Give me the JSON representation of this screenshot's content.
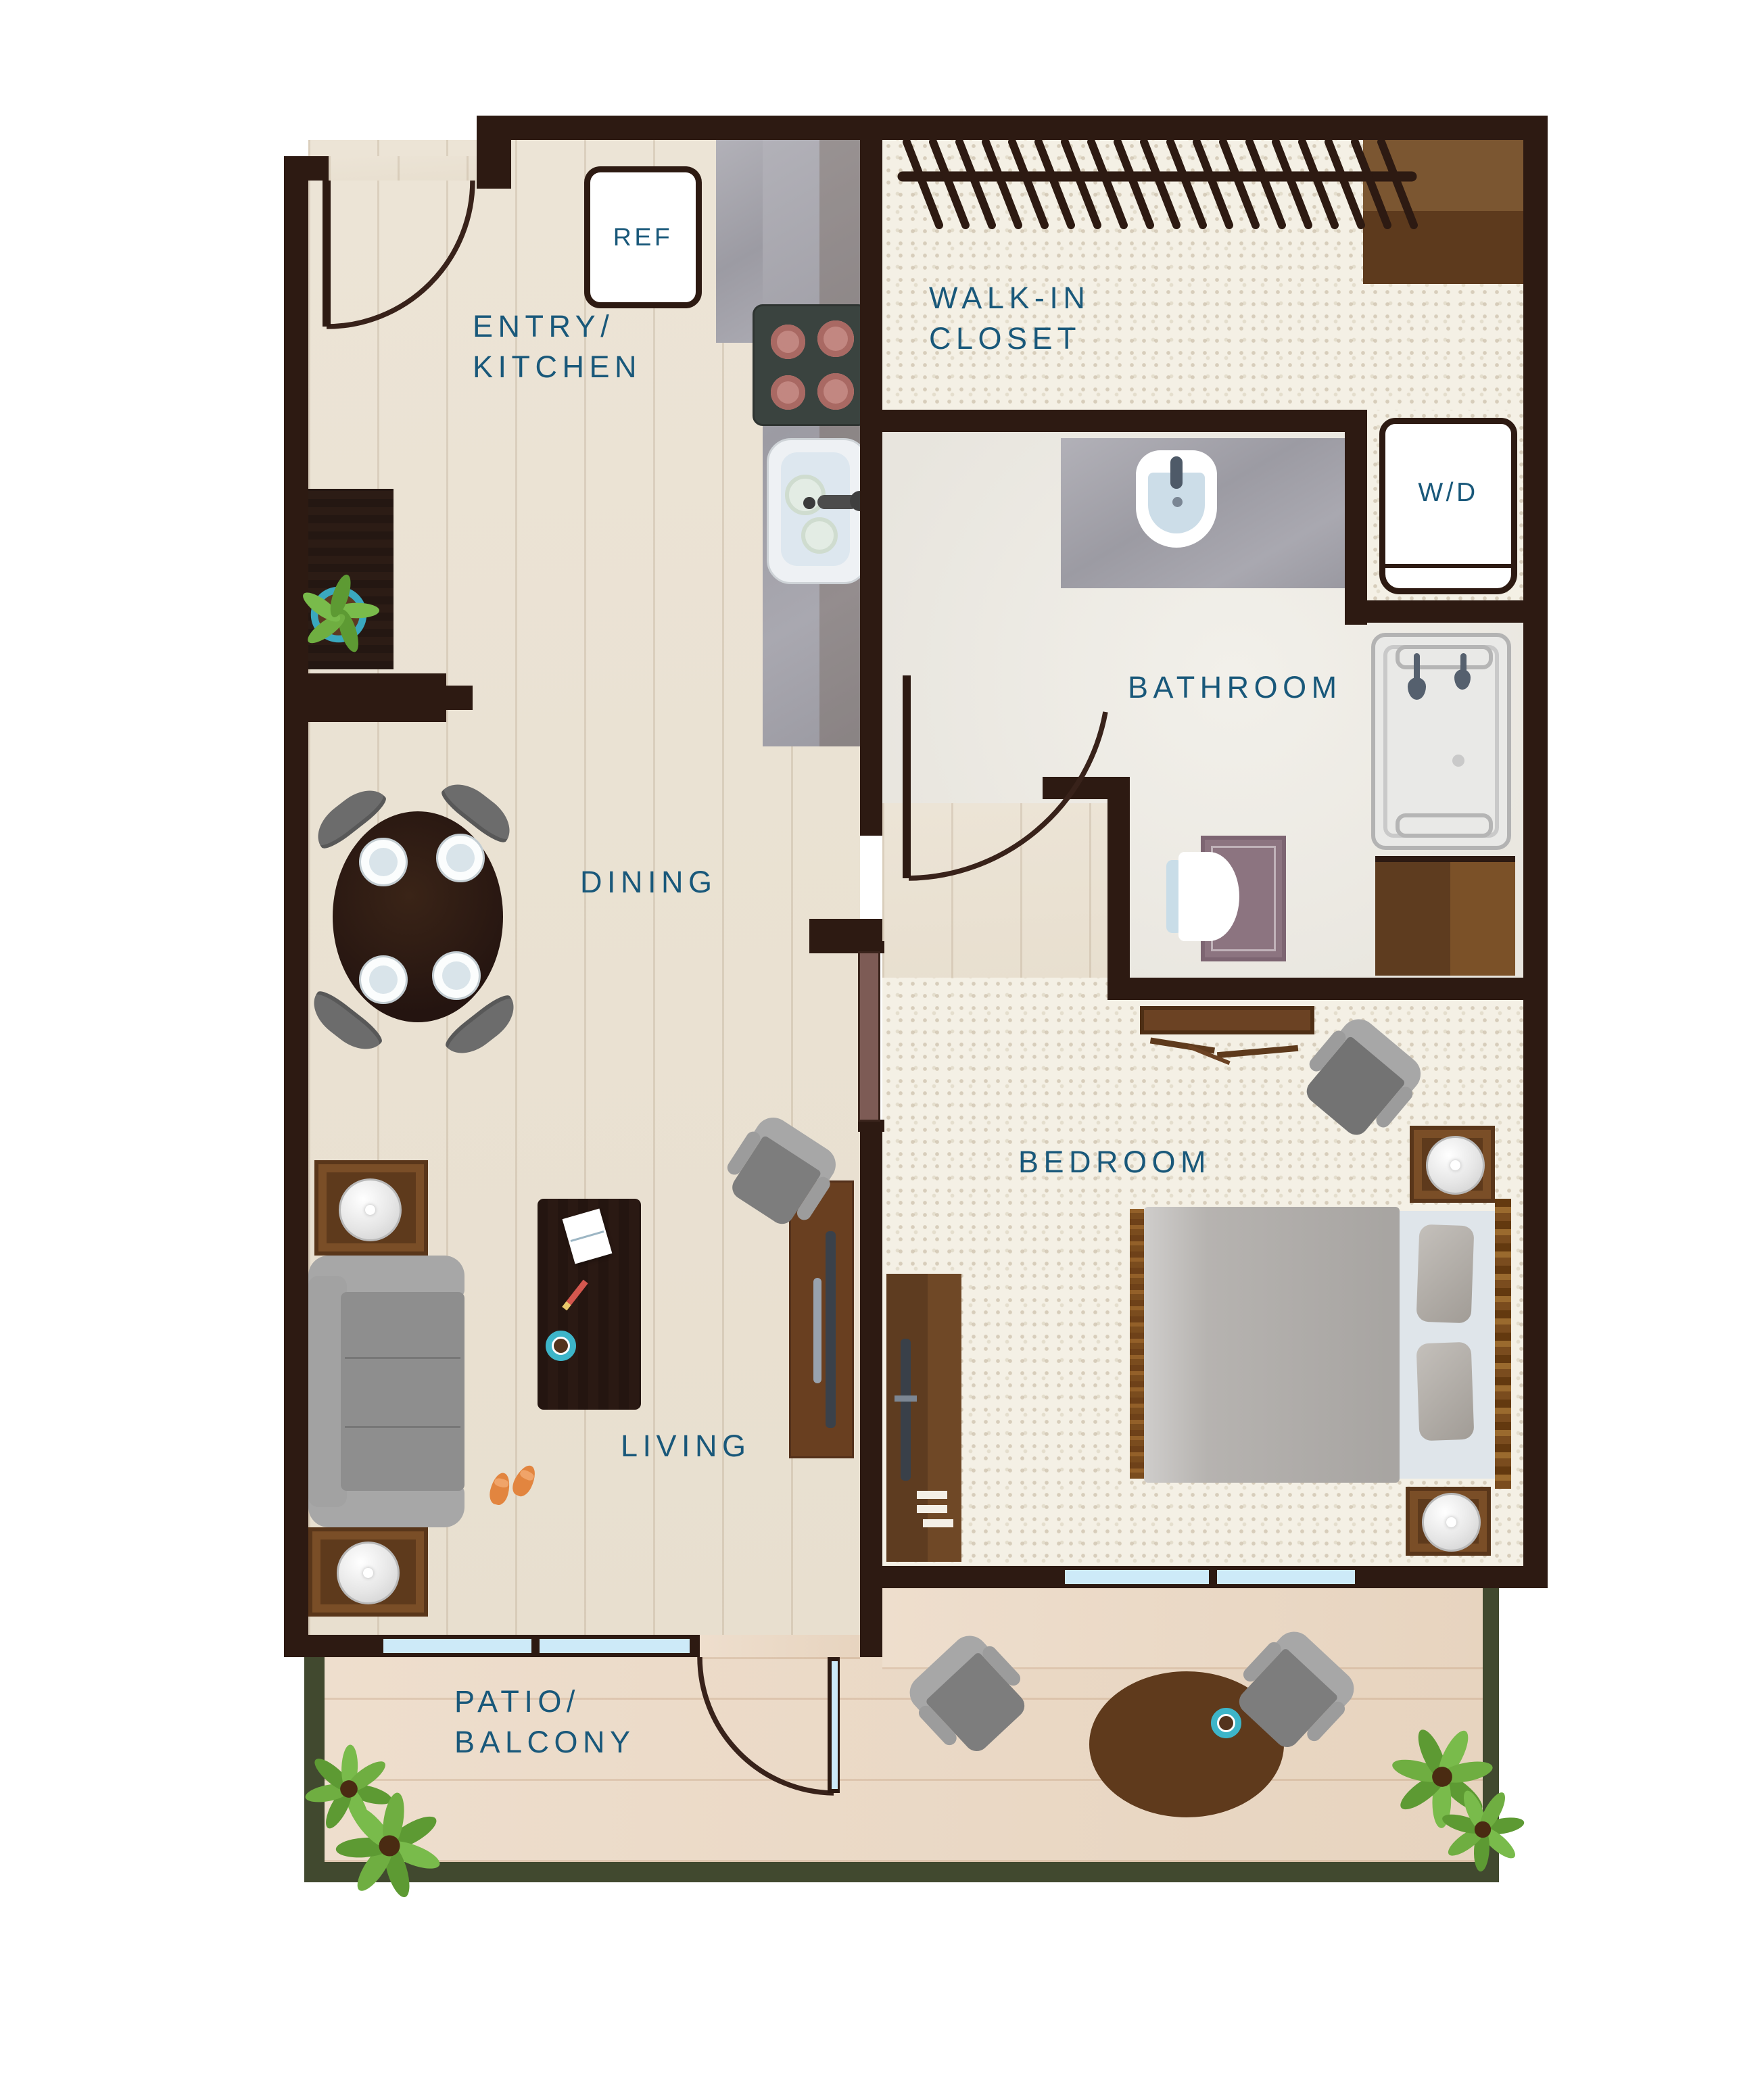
{
  "plan": {
    "title": "One-bedroom apartment floor plan",
    "rooms": [
      {
        "id": "entry-kitchen",
        "lines": [
          "ENTRY/",
          "KITCHEN"
        ]
      },
      {
        "id": "walk-in-closet",
        "lines": [
          "WALK-IN",
          "CLOSET"
        ]
      },
      {
        "id": "bathroom",
        "lines": [
          "BATHROOM"
        ]
      },
      {
        "id": "dining",
        "lines": [
          "DINING"
        ]
      },
      {
        "id": "bedroom",
        "lines": [
          "BEDROOM"
        ]
      },
      {
        "id": "living",
        "lines": [
          "LIVING"
        ]
      },
      {
        "id": "patio-balcony",
        "lines": [
          "PATIO/",
          "BALCONY"
        ]
      }
    ],
    "appliances": [
      {
        "id": "refrigerator",
        "label": "REF"
      },
      {
        "id": "washer-dryer",
        "label": "W/D"
      }
    ],
    "colors": {
      "wall": "#2d1a12",
      "room_label": "#19587a",
      "wood_floor": "#ece4d6",
      "carpet": "#f4f0e5",
      "bath_floor": "#edeae4",
      "patio_floor": "#ecd9c7",
      "patio_border": "#41492f",
      "counter_stone": "#a6a6ad",
      "cabinet_brown": "#6b4223",
      "accent_teal": "#3db5c9",
      "window_glass": "#cdeaf8",
      "burner_pink": "#c3847f",
      "plant_green": "#6aa93c",
      "slipper_orange": "#e2853f"
    }
  }
}
